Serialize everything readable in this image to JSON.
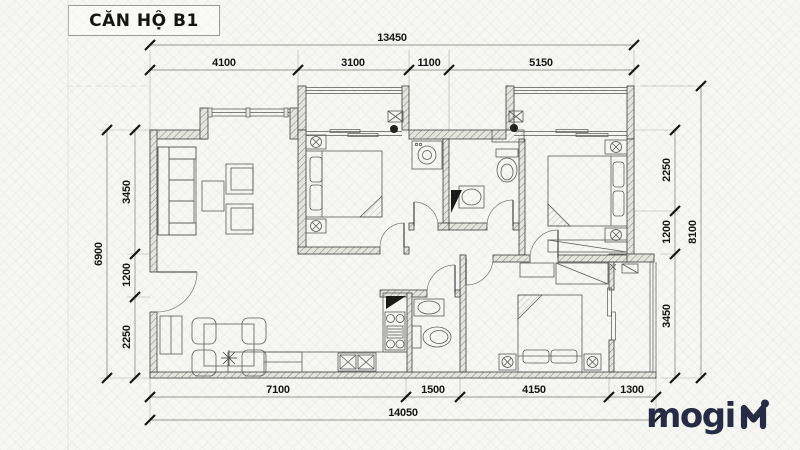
{
  "title": "CĂN HỘ B1",
  "brand": {
    "name": "mogi"
  },
  "dimensions": {
    "top": {
      "overall": "13450",
      "segments": [
        "4100",
        "3100",
        "1100",
        "5150"
      ]
    },
    "bottom": {
      "overall": "14050",
      "segments": [
        "7100",
        "1500",
        "4150",
        "1300"
      ]
    },
    "left": {
      "overall": "6900",
      "segments": [
        "3450",
        "1200",
        "2250"
      ]
    },
    "right": {
      "overall": "8100",
      "segments": [
        "2250",
        "1200",
        "3450"
      ]
    }
  },
  "colors": {
    "background": "#f6f6f3",
    "wall_line": "#3c3c3c",
    "dimension_text": "#141414",
    "brand_navy": "#272b45"
  }
}
